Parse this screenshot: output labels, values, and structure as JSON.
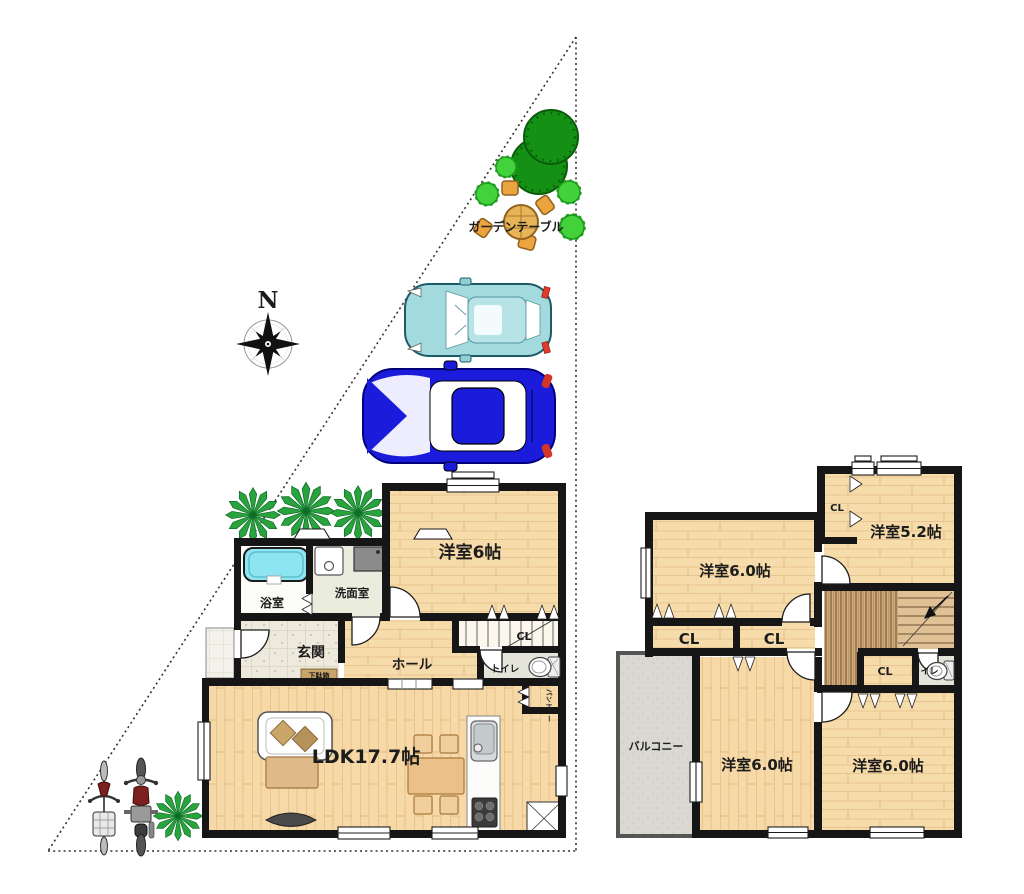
{
  "site": {
    "compass": "N",
    "garden_table_label": "ガーデンテーブル"
  },
  "floor1": {
    "western_room": "洋室6帖",
    "bathroom": "浴室",
    "washroom": "洗面室",
    "entrance": "玄関",
    "shoe_cabinet": "下駄箱",
    "hall": "ホール",
    "closet": "CL",
    "toilet": "トイレ",
    "pantry": "パントリー",
    "ldk": "LDK17.7帖"
  },
  "floor2": {
    "room_nw": "洋室6.0帖",
    "room_ne": "洋室5.2帖",
    "closet_top": "CL",
    "closet_a": "CL",
    "closet_b": "CL",
    "closet_c": "CL",
    "toilet": "トイレ",
    "balcony": "バルコニー",
    "room_sw": "洋室6.0帖",
    "room_se": "洋室6.0帖"
  },
  "colors": {
    "wall": "#161616",
    "wood_floor": "#f7dcab",
    "bathtub": "#8ce5f0",
    "tree": "#149114",
    "bush": "#44d23c",
    "car_compact": "#a3dade",
    "car_sport": "#1b1bdc",
    "entrance_tile": "#ede9dc",
    "balcony_floor": "#dad9d1",
    "stair_wood": "#d2ab7c"
  }
}
